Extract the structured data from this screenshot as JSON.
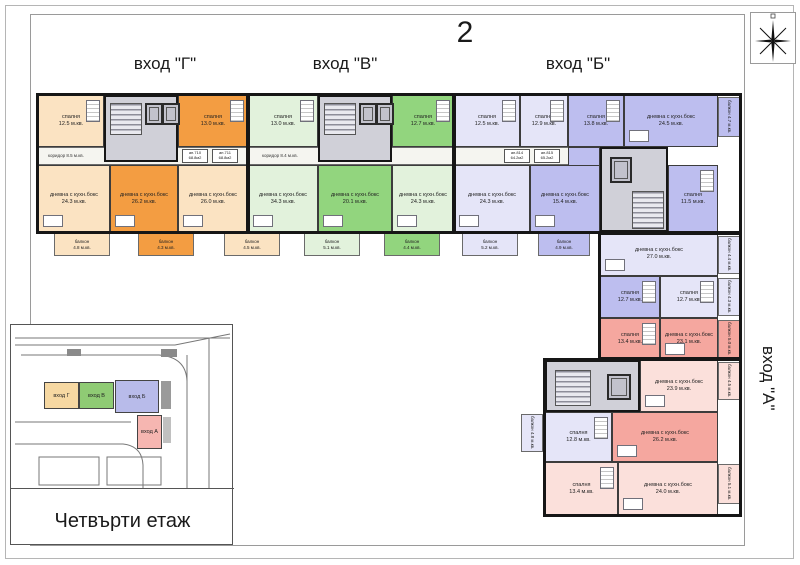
{
  "page": {
    "sheet_number": "2",
    "floor_caption": "Четвърти етаж"
  },
  "entrances": {
    "g": {
      "label": "вход \"Г\"",
      "color": "#F39D42"
    },
    "v": {
      "label": "вход \"В\"",
      "color": "#92D57E"
    },
    "b": {
      "label": "вход \"Б\"",
      "color": "#BDBEEF"
    },
    "a": {
      "label": "вход \"А\"",
      "color": "#F5A79F"
    }
  },
  "corridor": {
    "c1": "коридор 8.5 м.кв.",
    "c2": "коридор 8.4 м.кв.",
    "tags": {
      "t1": "ап.710\n68.8м2",
      "t2": "ап.711\n68.8м2",
      "t3": "ап.814\n64.2м2",
      "t4": "ап.815\n65.2м2"
    }
  },
  "rooms": {
    "r01": {
      "label": "спалня\n12.5 м.кв."
    },
    "r02": {
      "label": "спалня\n13.0 м.кв."
    },
    "r03": {
      "label": "спалня\n13.0 м.кв."
    },
    "r04": {
      "label": "спалня\n12.7 м.кв."
    },
    "r05": {
      "label": "спалня\n12.5 м.кв."
    },
    "r06": {
      "label": "спалня\n12.9 м.кв."
    },
    "r07": {
      "label": "спалня\n13.8 м.кв."
    },
    "r08": {
      "label": "дневна с кухн.бокс\n24.5 м.кв."
    },
    "r09": {
      "label": "дневна с кухн.бокс\n24.3 м.кв."
    },
    "r10": {
      "label": "дневна с кухн.бокс\n26.2 м.кв."
    },
    "r11": {
      "label": "дневна с кухн.бокс\n26.0 м.кв."
    },
    "r12": {
      "label": "дневна с кухн.бокс\n34.3 м.кв."
    },
    "r13": {
      "label": "дневна с кухн.бокс\n20.1 м.кв."
    },
    "r14": {
      "label": "дневна с кухн.бокс\n24.3 м.кв."
    },
    "r15": {
      "label": "дневна с кухн.бокс\n24.3 м.кв."
    },
    "r16": {
      "label": "дневна с кухн.бокс\n15.4 м.кв."
    },
    "r17": {
      "label": "спалня\n11.5 м.кв."
    },
    "r18": {
      "label": "дневна с кухн.бокс\n27.0 м.кв."
    },
    "r19": {
      "label": "спалня\n12.7 м.кв."
    },
    "r20": {
      "label": "спалня\n12.7 м.кв."
    },
    "r21": {
      "label": "спалня\n13.4 м.кв."
    },
    "r22": {
      "label": "дневна с кухн.бокс\n23.1 м.кв."
    },
    "r23": {
      "label": "дневна с кухн.бокс\n23.9 м.кв."
    },
    "r24": {
      "label": "спалня\n12.8 м.кв."
    },
    "r25": {
      "label": "дневна с кухн.бокс\n26.2 м.кв."
    },
    "r26": {
      "label": "спалня\n13.4 м.кв."
    },
    "r27": {
      "label": "дневна с кухн.бокс\n24.0 м.кв."
    },
    "r28": {
      "label": "коридор\n3.8 м.кв."
    }
  },
  "balconies": {
    "b01": {
      "label": "балкон\n4.8 м.кв."
    },
    "b02": {
      "label": "балкон\n4.3 м.кв."
    },
    "b03": {
      "label": "балкон\n4.5 м.кв."
    },
    "b04": {
      "label": "балкон\n5.1 м.кв."
    },
    "b05": {
      "label": "балкон\n4.4 м.кв."
    },
    "b06": {
      "label": "балкон\n5.2 м.кв."
    },
    "b07": {
      "label": "балкон\n4.9 м.кв."
    },
    "b08": {
      "label": "балкон 4.7 м.кв."
    },
    "b09": {
      "label": "балкон 4.4 м.кв."
    },
    "b10": {
      "label": "балкон 4.3 м.кв."
    },
    "b11": {
      "label": "балкон 5.0 м.кв."
    },
    "b12": {
      "label": "балкон 4.5 м.кв."
    },
    "b13": {
      "label": "балкон 4.8 м.кв."
    },
    "b14": {
      "label": "балкон 5.1 м.кв."
    }
  },
  "inset": {
    "blocks": {
      "g": "вход Г",
      "v": "вход В",
      "b": "вход Б",
      "a": "вход А"
    },
    "caption": "Четвърти етаж"
  }
}
